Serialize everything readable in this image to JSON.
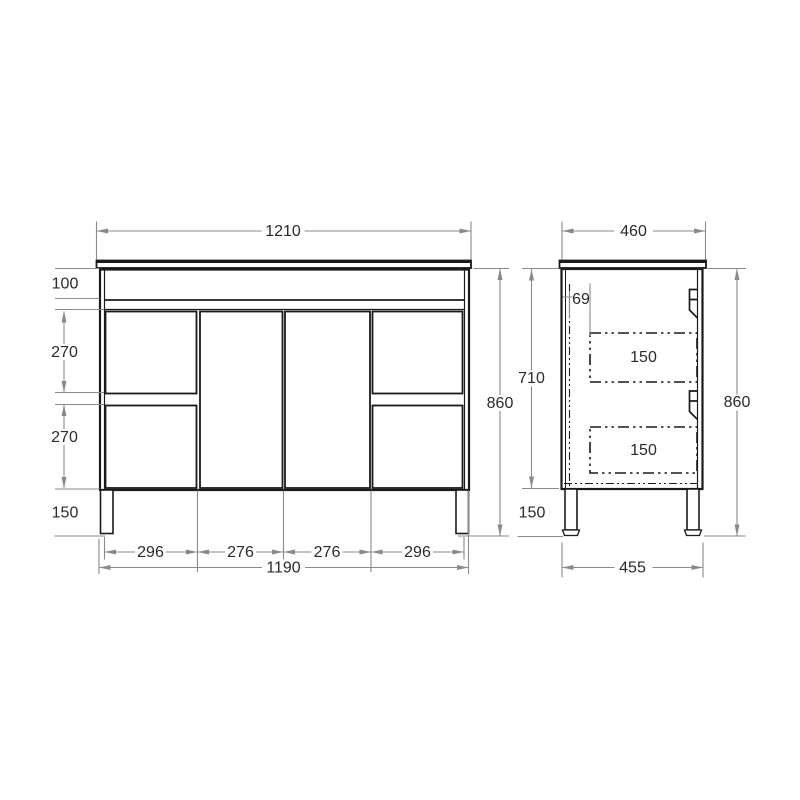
{
  "drawing_type": "vanity-cabinet-dimension-drawing",
  "front_view": {
    "countertop_width": "1210",
    "top_band_height": "100",
    "upper_drawer_height": "270",
    "lower_drawer_height": "270",
    "leg_height": "150",
    "overall_height": "860",
    "left_drawers_width": "296",
    "left_door_width": "276",
    "right_door_width": "276",
    "right_drawers_width": "296",
    "carcass_width": "1190"
  },
  "side_view": {
    "countertop_depth": "460",
    "drawer_setback": "69",
    "carcass_height": "710",
    "overall_height": "860",
    "upper_drawer_box_height": "150",
    "lower_drawer_box_height": "150",
    "leg_height": "150",
    "carcass_depth": "455"
  },
  "colors": {
    "cabinet_line": "#1a1a1a",
    "dimension_line": "#8a8a8a",
    "text": "#2a2a2a",
    "background": "#ffffff"
  }
}
